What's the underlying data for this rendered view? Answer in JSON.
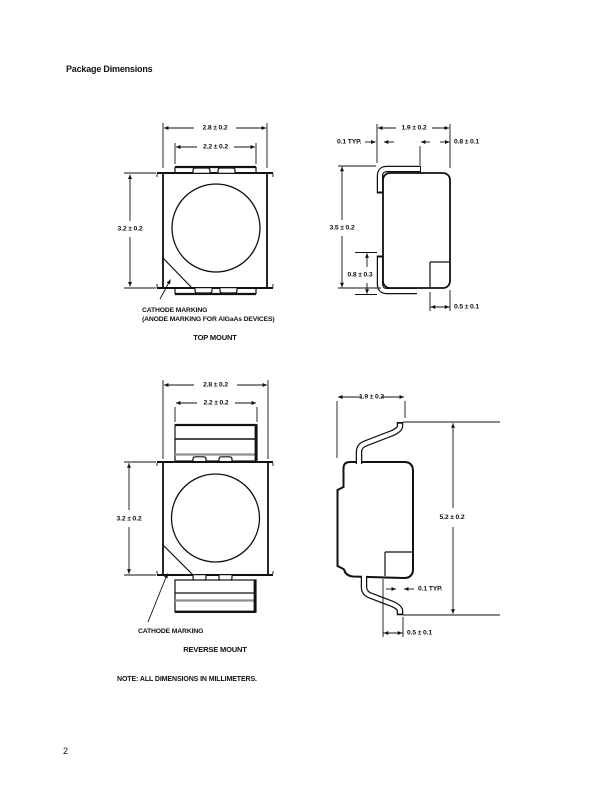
{
  "page": {
    "title": "Package Dimensions",
    "note": "NOTE: ALL DIMENSIONS IN MILLIMETERS.",
    "page_number": "2"
  },
  "top_mount": {
    "caption": "TOP MOUNT",
    "cathode_marking_line1": "CATHODE MARKING",
    "cathode_marking_line2": "(ANODE MARKING FOR AlGaAs DEVICES)",
    "front": {
      "outer_width": "2.8 ± 0.2",
      "inner_width": "2.2 ± 0.2",
      "height": "3.2 ± 0.2"
    },
    "side": {
      "width": "1.9 ± 0.2",
      "lead_thickness": "0.1 TYP.",
      "top_offset": "0.8 ± 0.1",
      "height": "3.5 ± 0.2",
      "lead_height": "0.8 ± 0.3",
      "foot_width": "0.5 ± 0.1"
    }
  },
  "reverse_mount": {
    "caption": "REVERSE MOUNT",
    "cathode_marking": "CATHODE MARKING",
    "front": {
      "outer_width": "2.8 ± 0.2",
      "inner_width": "2.2 ± 0.2",
      "height": "3.2 ± 0.2"
    },
    "side": {
      "width": "1.9 ± 0.2",
      "height": "5.2 ± 0.2",
      "lead_thickness": "0.1 TYP.",
      "foot_width": "0.5 ± 0.1"
    }
  }
}
